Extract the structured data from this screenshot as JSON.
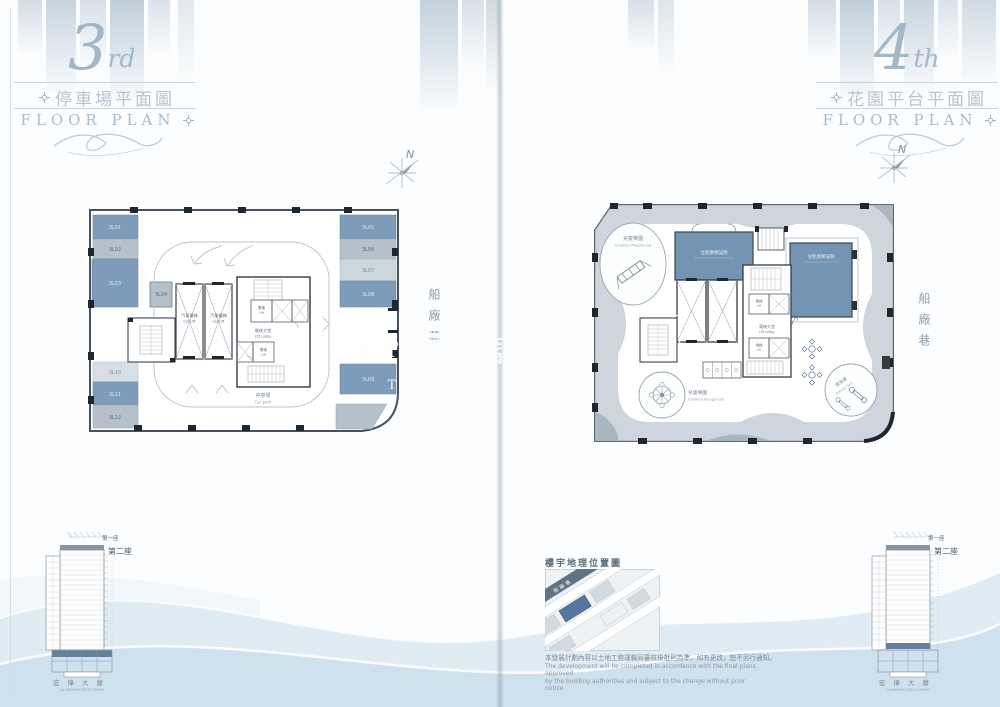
{
  "watermark": {
    "prefix": "L.T.",
    "cn": "信",
    "en": "TRUST"
  },
  "colors": {
    "stall_blue": "#7d9cba",
    "stall_gray": "#b5c0c9",
    "room_blue": "#7394b3",
    "floor_highlight": "#64809a",
    "swoosh": "#c9dfee"
  },
  "pages": {
    "left": {
      "title": {
        "num": "3",
        "suffix": "rd",
        "cn": "停車場平面圖",
        "en": "FLOOR PLAN"
      },
      "compass": "N",
      "street": "船廠巷",
      "plan": {
        "car_lift_cn": "汽車電梯",
        "car_lift_en": "Car Lift",
        "lift_cn": "電梯",
        "lift_en": "Lift",
        "lobby_cn": "電梯大堂",
        "lobby_en": "Lift Lobby",
        "carpark_cn": "停車場",
        "carpark_en": "Car park",
        "stalls": [
          {
            "label": "3L01"
          },
          {
            "label": "3L02"
          },
          {
            "label": "3L03"
          },
          {
            "label": "3L04"
          },
          {
            "label": "3L05"
          },
          {
            "label": "3L06"
          },
          {
            "label": "3L07"
          },
          {
            "label": "3L08"
          },
          {
            "label": "3L09"
          },
          {
            "label": "3L10"
          },
          {
            "label": "3L11"
          },
          {
            "label": "3L12"
          }
        ]
      },
      "tower": {
        "t1": "第一座",
        "t2": "第二座",
        "name_cn": "宏偉大廈",
        "name_en": "LA MAGNIFICENCE TOWER"
      }
    },
    "right": {
      "title": {
        "num": "4",
        "suffix": "th",
        "cn": "花園平台平面圖",
        "en": "FLOOR PLAN"
      },
      "compass": "N",
      "street": "船廠巷",
      "plan": {
        "playground_cn": "兒童樂園",
        "playground_en": "Children Playground",
        "room_cn": "住客康樂設施",
        "activity_cn": "健身處",
        "activity_en": "Activity Spot",
        "lift_cn": "電梯",
        "lift_en": "Lift",
        "lobby_cn": "電梯大堂",
        "lobby_en": "Lift Lobby"
      },
      "map": {
        "title": "樓宇地理位置圖",
        "street": "船廠巷"
      },
      "disclaimer": {
        "cn": "本發展計劃內容以土地工務運輸局審核後批則為準，如有更改，恕不另行通知。",
        "en1": "The development will be completed in accordance with the final plans approved",
        "en2": "by the building authorities and subject to the change without prior notice."
      },
      "tower": {
        "t1": "第一座",
        "t2": "第二座",
        "name_cn": "宏偉大廈",
        "name_en": "LA MAGNIFICENCE TOWER"
      }
    }
  }
}
